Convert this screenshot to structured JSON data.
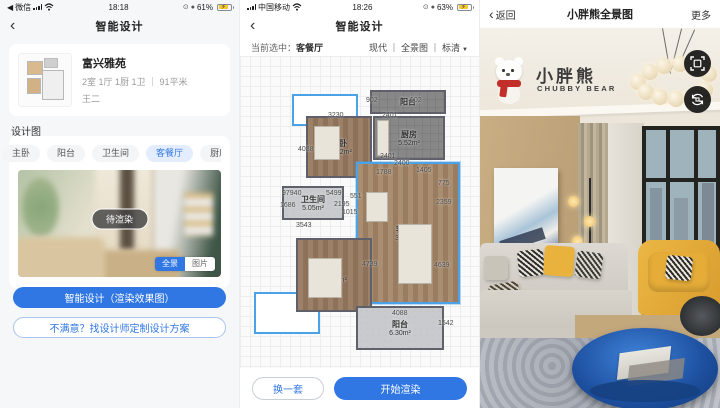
{
  "accent": "#3077e3",
  "left_panel": {
    "status_bar": {
      "app_indicator": "◀",
      "app": "微信",
      "time": "18:18",
      "alarm": "⊙",
      "lock": "●",
      "battery": "61%",
      "bolt": "⚡"
    },
    "nav": {
      "back": "‹",
      "title": "智能设计"
    },
    "property_card": {
      "name": "富兴雅苑",
      "specs": "2室 1厅 1厨 1卫 ｜ 91平米",
      "owner": "王二"
    },
    "section_title": "设计图",
    "tabs": [
      {
        "label": "主卧",
        "active": false
      },
      {
        "label": "阳台",
        "active": false
      },
      {
        "label": "卫生间",
        "active": false
      },
      {
        "label": "客餐厅",
        "active": true
      },
      {
        "label": "厨房",
        "active": false
      }
    ],
    "preview": {
      "badge": "待渲染",
      "toggle": [
        "全景",
        "图片"
      ],
      "toggle_active": "全景"
    },
    "primary_button": "智能设计（渲染效果图）",
    "secondary_button": "不满意？找设计师定制设计方案"
  },
  "middle_panel": {
    "status_bar": {
      "carrier": "中国移动",
      "time": "18:26",
      "alarm": "⊙",
      "lock": "●",
      "battery": "63%",
      "bolt": "⚡"
    },
    "nav": {
      "back": "‹",
      "title": "智能设计"
    },
    "selection_bar": {
      "label": "当前选中：",
      "value": "客餐厅",
      "options": "现代 ｜ 全景图 ｜ 标清",
      "caret": "▼"
    },
    "floorplan": {
      "rooms": [
        {
          "name": "阳台",
          "area": "2.17m²"
        },
        {
          "name": "厨房",
          "area": "5.52m²"
        },
        {
          "name": "次卧",
          "area": "13.22m²"
        },
        {
          "name": "卫生间",
          "area": "5.05m²"
        },
        {
          "name": "客餐厅",
          "area": "32.04m²"
        },
        {
          "name": "主卧",
          "area": "15.94m²"
        },
        {
          "name": "阳台",
          "area": "6.30m²"
        }
      ],
      "dims": [
        {
          "t": "3230",
          "x": 88,
          "y": 56
        },
        {
          "t": "902",
          "x": 126,
          "y": 41
        },
        {
          "t": "902",
          "x": 170,
          "y": 41
        },
        {
          "t": "2401",
          "x": 142,
          "y": 56
        },
        {
          "t": "2401",
          "x": 140,
          "y": 97
        },
        {
          "t": "2400",
          "x": 154,
          "y": 104
        },
        {
          "t": "1788",
          "x": 136,
          "y": 113
        },
        {
          "t": "1405",
          "x": 176,
          "y": 111
        },
        {
          "t": "775",
          "x": 198,
          "y": 124
        },
        {
          "t": "97940",
          "x": 42,
          "y": 134
        },
        {
          "t": "5499",
          "x": 86,
          "y": 134
        },
        {
          "t": "551",
          "x": 110,
          "y": 137
        },
        {
          "t": "1686",
          "x": 40,
          "y": 146
        },
        {
          "t": "2195",
          "x": 94,
          "y": 145
        },
        {
          "t": "1015",
          "x": 102,
          "y": 153
        },
        {
          "t": "2359",
          "x": 196,
          "y": 143
        },
        {
          "t": "3543",
          "x": 56,
          "y": 166
        },
        {
          "t": "4088",
          "x": 58,
          "y": 90
        },
        {
          "t": "4739",
          "x": 122,
          "y": 205
        },
        {
          "t": "4639",
          "x": 194,
          "y": 206
        },
        {
          "t": "4088",
          "x": 152,
          "y": 254
        },
        {
          "t": "1542",
          "x": 198,
          "y": 264
        }
      ]
    },
    "buttons": {
      "change": "换一套",
      "render": "开始渲染"
    }
  },
  "right_panel": {
    "nav": {
      "back_chevron": "‹",
      "back": "返回",
      "title": "小胖熊全景图",
      "more": "更多"
    },
    "logo": {
      "cn": "小胖熊",
      "en": "CHUBBY BEAR"
    }
  }
}
